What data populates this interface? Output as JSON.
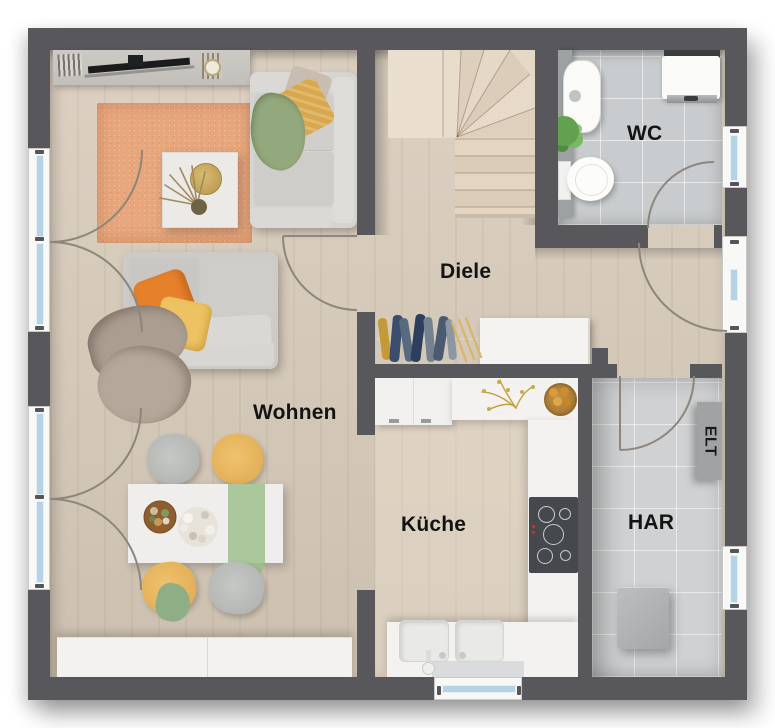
{
  "plan": {
    "rooms": [
      {
        "id": "wohnen",
        "label": "Wohnen"
      },
      {
        "id": "diele",
        "label": "Diele"
      },
      {
        "id": "wc",
        "label": "WC"
      },
      {
        "id": "kueche",
        "label": "Küche"
      },
      {
        "id": "har",
        "label": "HAR"
      },
      {
        "id": "elt",
        "label": "ELT"
      }
    ],
    "colors": {
      "wall": "#58585c",
      "wood_floor": "#d7cab9",
      "wc_tile": "#c9ccce",
      "har_tile": "#cfd1d3",
      "rug": "#e7a67c",
      "counter": "#f3f2f0",
      "sofa": "#d4d2cf",
      "accent_orange": "#e5802b",
      "accent_yellow": "#edc262",
      "accent_green": "#94a87d",
      "window_glass": "#b5d3e6"
    }
  }
}
